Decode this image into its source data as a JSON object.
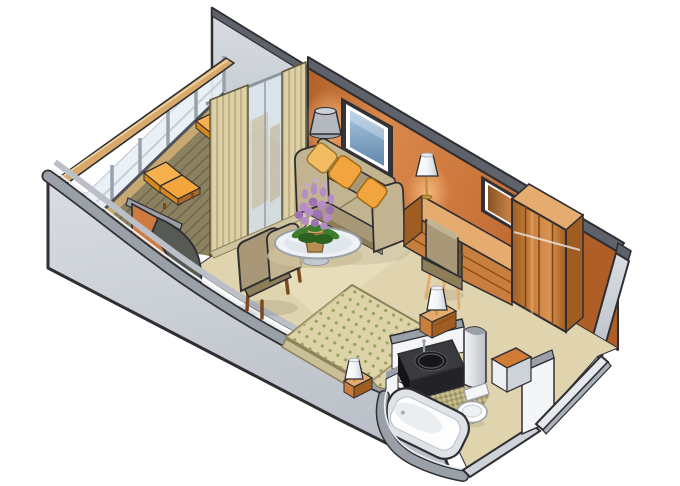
{
  "meta": {
    "title": "Stateroom suite isometric cutaway floor plan with private veranda",
    "figure_type": "illustrated 3D floor plan",
    "background": "#ffffff"
  },
  "scene": {
    "areas": [
      {
        "id": "veranda",
        "label": "Private veranda with two sun loungers and glass railing"
      },
      {
        "id": "living-area",
        "label": "Sitting area with sofa, armchair and glass cocktail table"
      },
      {
        "id": "bedroom",
        "label": "Bedroom area with double bed and two bedside lamps"
      },
      {
        "id": "vanity-area",
        "label": "Writing desk with lamp, chair and drawer chests with mirror"
      },
      {
        "id": "wardrobe",
        "label": "Paneled wardrobe closet"
      },
      {
        "id": "bathroom",
        "label": "Bathroom with bathtub, washbasin vanity and toilet"
      },
      {
        "id": "entry",
        "label": "Entry vestibule with bench"
      }
    ],
    "objects": [
      {
        "id": "lounge-chairs",
        "label": "Two orange sun loungers",
        "count": 2
      },
      {
        "id": "railing",
        "label": "Glass balustrade with wooden handrail"
      },
      {
        "id": "sliding-door",
        "label": "Sliding glass door with striped drapes"
      },
      {
        "id": "floor-lamp",
        "label": "Floor lamp with gray shade"
      },
      {
        "id": "sofa",
        "label": "Khaki sofa with three orange pillows"
      },
      {
        "id": "wall-picture",
        "label": "Framed blue picture / TV on wall"
      },
      {
        "id": "wall-mirror",
        "label": "Framed mirror above dresser"
      },
      {
        "id": "coffee-table",
        "label": "Round glass table with purple flower pot"
      },
      {
        "id": "armchair",
        "label": "Khaki armchair"
      },
      {
        "id": "desk",
        "label": "Wooden vanity desk with white table lamp"
      },
      {
        "id": "desk-chair",
        "label": "Upholstered desk chair"
      },
      {
        "id": "bed",
        "label": "Double bed with dotted bedspread"
      },
      {
        "id": "bedside-lamps",
        "label": "Two white bedside lamps on wood nightstands",
        "count": 2
      },
      {
        "id": "bathtub",
        "label": "White bathtub"
      },
      {
        "id": "vanity-sink",
        "label": "Black vanity counter with round basin"
      },
      {
        "id": "toilet",
        "label": "Toilet"
      },
      {
        "id": "bench",
        "label": "Entry bench with orange cushion"
      }
    ]
  },
  "colors": {
    "outline": "#2e2e33",
    "wall_gray_light": "#d9dde3",
    "wall_gray_mid": "#bbc0c8",
    "wall_gray_band": "#9aa0a8",
    "wall_gray_dark": "#5e626a",
    "wall_highlight": "#eaecef",
    "wall_white": "#f4f5f7",
    "face_gray": "#ced3d9",
    "wall_orange": "#cf7a3f",
    "wall_orange_mid": "#d8884c",
    "wall_orange_dark": "#b05e27",
    "glow_orange": "#f7bc80",
    "floor_carpet": "#e0d4ae",
    "floor_carpet_light": "#eee3c4",
    "deck_wood": "#8b8160",
    "deck_wood_dark": "#6e6549",
    "deck_trim": "#c7a871",
    "rail_wood": "#d8a96b",
    "rail_wood_light": "#f0d7a7",
    "rail_glass": "#e9f0f6",
    "rail_post": "#9aa1ab",
    "rail_base": "#4e525a",
    "lounge_orange": "#f4a63c",
    "lounge_orange_light": "#f6b14e",
    "lounge_orange_dark": "#d8871c",
    "lounge_pad": "#b06a28",
    "sofa_tan": "#a89877",
    "sofa_tan_light": "#c2b490",
    "sofa_tan_dark": "#8d7e58",
    "pillow_orange": "#f2a53f",
    "pillow_cream": "#f3bc63",
    "wood": "#c87f3e",
    "wood_mid": "#d9924f",
    "wood_dark": "#a05d22",
    "wood_light": "#e5ab6f",
    "wood_deep": "#7a4a1e",
    "wood_seam": "#8a4d16",
    "tv_frame": "#35353b",
    "tv_screen_light": "#a9c6e0",
    "tv_screen_dark": "#6288ab",
    "mirror_dark": "#8a5420",
    "mirror_light": "#c8854a",
    "lamp_gray": "#b4b8bf",
    "lamp_gray_light": "#cdd1d6",
    "lamp_white": "#f2f4f7",
    "lamp_white_dim": "#c6ccd4",
    "brass": "#c09040",
    "bed_spread": "#ded2a8",
    "bed_dot": "#93a45c",
    "bed_skirt": "#cbbf98",
    "bed_crease": "#a79a73",
    "bath_white": "#fdfdfe",
    "bath_rim": "#dfe3e7",
    "vanity_black": "#3a3a41",
    "vanity_deep": "#17171b",
    "vanity_front": "#232327",
    "tile_tan": "#c9bd8f",
    "tile_olive": "#9d9566",
    "flower_purple": "#b58cc8",
    "flower_purple_dark": "#9d71b5",
    "flower_light": "#c9a8d8",
    "leaf_green": "#3f7d2e",
    "leaf_green_dark": "#2c611f",
    "pot_tan": "#b98e52",
    "pot_rim": "#d2a868",
    "glass_table": "#eef1f5",
    "table_inner": "#dfe6ec",
    "shadow_tan": "#cdc19b",
    "curtain_tan": "#ddd1a7",
    "curtain_shadow": "#c2b287",
    "bench_top": "#d07b36"
  }
}
